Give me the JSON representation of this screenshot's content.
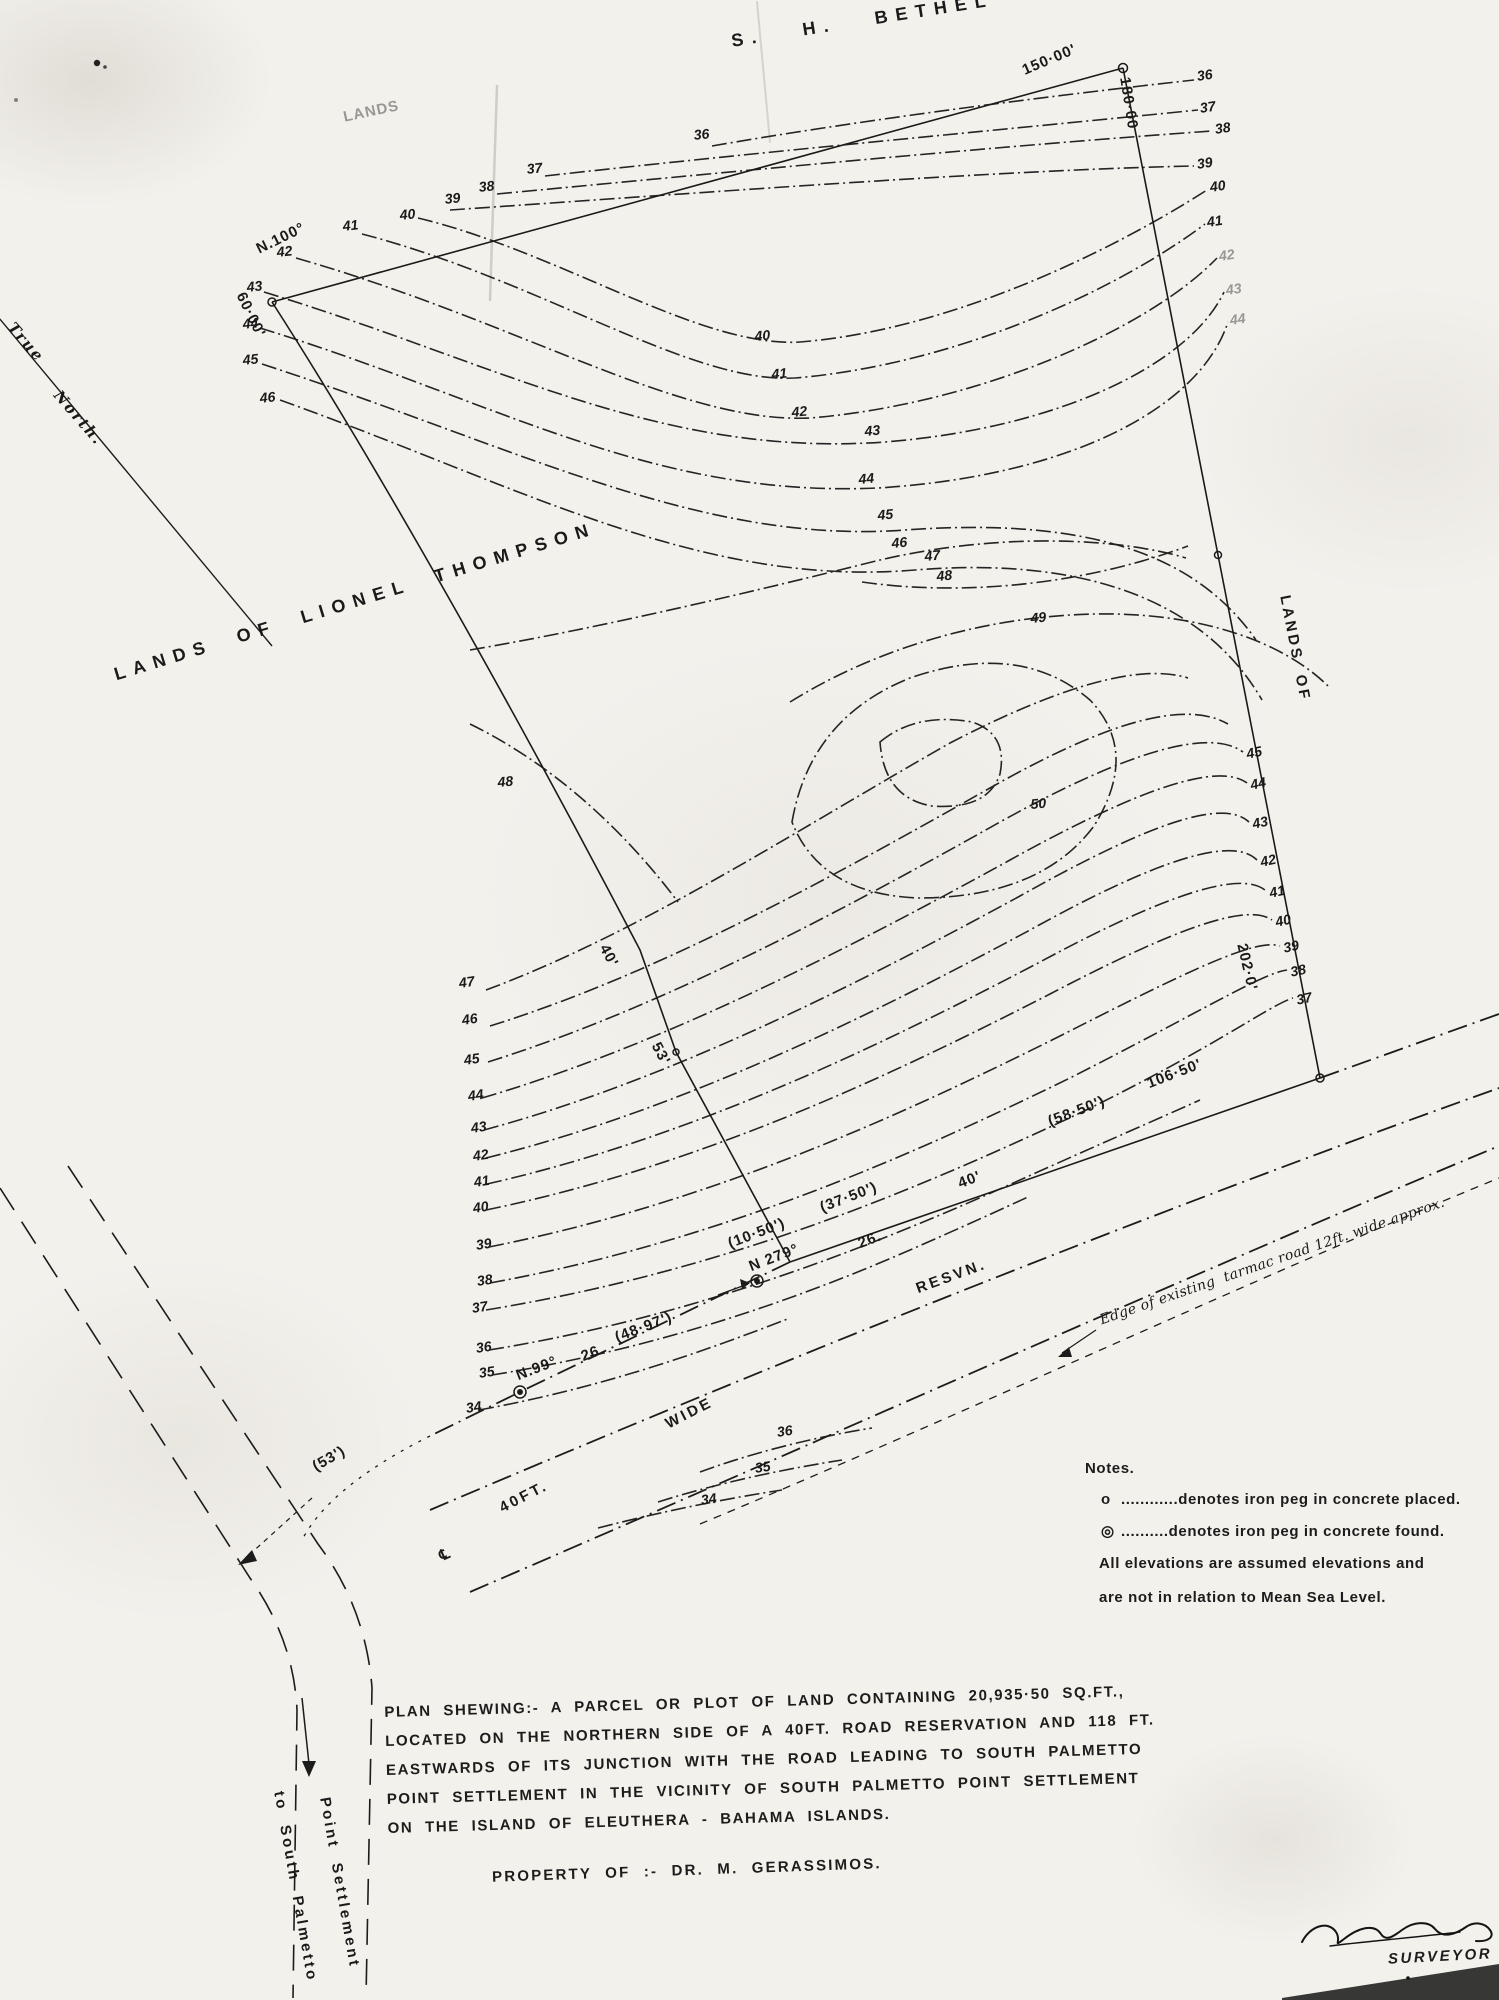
{
  "colors": {
    "ink": "#1c1c1c",
    "paper": "#f3f1ec"
  },
  "north": {
    "label1": "True",
    "label2": "North."
  },
  "notes": {
    "title": "Notes.",
    "rows": [
      {
        "sym": "o",
        "text": "............denotes iron  peg  in concrete  placed."
      },
      {
        "sym": "◎",
        "text": "..........denotes  iron  peg  in concrete  found."
      }
    ],
    "line3": "All elevations  are  assumed  elevations  and",
    "line4": "are  not  in relation  to  Mean  Sea  Level."
  },
  "description": {
    "line1": "PLAN  SHEWING:-   A  PARCEL  OR  PLOT  OF  LAND  CONTAINING  20,935·50 SQ.FT.,",
    "line2": "LOCATED  ON  THE  NORTHERN  SIDE  OF  A  40FT.  ROAD  RESERVATION  AND  118 FT.",
    "line3": "EASTWARDS  OF  ITS  JUNCTION  WITH  THE  ROAD  LEADING  TO  SOUTH  PALMETTO",
    "line4": "POINT  SETTLEMENT  IN  THE  VICINITY  OF  SOUTH  PALMETTO  POINT  SETTLEMENT",
    "line5": "ON  THE  ISLAND  OF  ELEUTHERA - BAHAMA  ISLANDS."
  },
  "property_of": "PROPERTY OF :-   DR.  M. GERASSIMOS.",
  "signature": {
    "role": "SURVEYOR"
  },
  "map_labels": [
    {
      "t": "S.   H.   BETHEL",
      "x": 730,
      "y": 32,
      "r": -9,
      "c": "big",
      "n": "neighbor-top-label"
    },
    {
      "t": "LANDS",
      "x": 342,
      "y": 110,
      "r": -12,
      "c": "med faint",
      "n": "faint-lands-label"
    },
    {
      "t": "LANDS  OF  LIONEL  THOMPSON",
      "x": 112,
      "y": 666,
      "r": -17,
      "c": "big",
      "n": "neighbor-west-label"
    },
    {
      "t": "LANDS  OF",
      "x": 1292,
      "y": 594,
      "r": 79,
      "c": "medsp",
      "n": "neighbor-east-label"
    },
    {
      "t": "True",
      "x": 16,
      "y": 320,
      "r": 49,
      "c": "ser",
      "n": "north-label"
    },
    {
      "t": "North.",
      "x": 62,
      "y": 388,
      "r": 49,
      "c": "ser",
      "n": "north-label"
    },
    {
      "t": "150·00'",
      "x": 1020,
      "y": 64,
      "r": -23,
      "c": "med",
      "n": "distance-label"
    },
    {
      "t": "180·00",
      "x": 1132,
      "y": 76,
      "r": 81,
      "c": "med",
      "n": "distance-label"
    },
    {
      "t": "N.100°",
      "x": 254,
      "y": 243,
      "r": -26,
      "c": "med",
      "n": "bearing-label"
    },
    {
      "t": "60·00'",
      "x": 247,
      "y": 290,
      "r": 64,
      "c": "med",
      "n": "distance-label"
    },
    {
      "t": "40'",
      "x": 610,
      "y": 942,
      "r": 62,
      "c": "med",
      "n": "distance-label"
    },
    {
      "t": "53'",
      "x": 662,
      "y": 1040,
      "r": 62,
      "c": "med",
      "n": "distance-label"
    },
    {
      "t": "202·0'",
      "x": 1249,
      "y": 942,
      "r": 77,
      "c": "med",
      "n": "distance-label"
    },
    {
      "t": "(10·50')",
      "x": 726,
      "y": 1237,
      "r": -21,
      "c": "med",
      "n": "distance-label"
    },
    {
      "t": "N 279°",
      "x": 747,
      "y": 1260,
      "r": -21,
      "c": "med",
      "n": "bearing-label"
    },
    {
      "t": "(37·50')",
      "x": 818,
      "y": 1201,
      "r": -21,
      "c": "med",
      "n": "distance-label"
    },
    {
      "t": "26.",
      "x": 856,
      "y": 1237,
      "r": -21,
      "c": "med",
      "n": "distance-label"
    },
    {
      "t": "40'",
      "x": 956,
      "y": 1177,
      "r": -21,
      "c": "med",
      "n": "distance-label"
    },
    {
      "t": "(58·50')",
      "x": 1046,
      "y": 1115,
      "r": -21,
      "c": "med",
      "n": "distance-label"
    },
    {
      "t": "106·50'",
      "x": 1145,
      "y": 1077,
      "r": -21,
      "c": "med",
      "n": "distance-label"
    },
    {
      "t": "26.",
      "x": 579,
      "y": 1350,
      "r": -21,
      "c": "med",
      "n": "distance-label"
    },
    {
      "t": "(48·97')",
      "x": 613,
      "y": 1331,
      "r": -21,
      "c": "med",
      "n": "distance-label"
    },
    {
      "t": "N.99°",
      "x": 514,
      "y": 1369,
      "r": -21,
      "c": "med",
      "n": "bearing-label"
    },
    {
      "t": "(53')",
      "x": 310,
      "y": 1461,
      "r": -30,
      "c": "med",
      "n": "distance-label"
    },
    {
      "t": "℄",
      "x": 437,
      "y": 1550,
      "r": -24,
      "c": "med",
      "n": "centerline-symbol"
    },
    {
      "t": "40FT.",
      "x": 497,
      "y": 1502,
      "r": -27,
      "c": "medsp",
      "n": "road-label"
    },
    {
      "t": "WIDE",
      "x": 663,
      "y": 1418,
      "r": -27,
      "c": "medsp",
      "n": "road-label"
    },
    {
      "t": "RESVN.",
      "x": 914,
      "y": 1282,
      "r": -20,
      "c": "medsp",
      "n": "road-label"
    },
    {
      "t": "Edge of existing  tarmac road 12ft. wide approx.",
      "x": 1098,
      "y": 1314,
      "r": -19,
      "c": "hand",
      "n": "road-annotation"
    },
    {
      "t": "to  South  Palmetto",
      "x": 286,
      "y": 1790,
      "r": 80,
      "c": "medsp",
      "n": "road-destination-label"
    },
    {
      "t": "Point  Settlement",
      "x": 332,
      "y": 1796,
      "r": 80,
      "c": "medsp",
      "n": "road-destination-label"
    },
    {
      "t": "36",
      "x": 693,
      "y": 128,
      "r": -6,
      "c": "num",
      "n": "contour-label"
    },
    {
      "t": "37",
      "x": 526,
      "y": 162,
      "r": -6,
      "c": "num",
      "n": "contour-label"
    },
    {
      "t": "38",
      "x": 478,
      "y": 180,
      "r": -6,
      "c": "num",
      "n": "contour-label"
    },
    {
      "t": "39",
      "x": 444,
      "y": 192,
      "r": -6,
      "c": "num",
      "n": "contour-label"
    },
    {
      "t": "40",
      "x": 399,
      "y": 208,
      "r": -6,
      "c": "num",
      "n": "contour-label"
    },
    {
      "t": "41",
      "x": 342,
      "y": 219,
      "r": -6,
      "c": "num",
      "n": "contour-label"
    },
    {
      "t": "42",
      "x": 276,
      "y": 245,
      "r": -6,
      "c": "num",
      "n": "contour-label"
    },
    {
      "t": "43",
      "x": 246,
      "y": 280,
      "r": -6,
      "c": "num",
      "n": "contour-label"
    },
    {
      "t": "44",
      "x": 242,
      "y": 317,
      "r": -6,
      "c": "num",
      "n": "contour-label"
    },
    {
      "t": "45",
      "x": 242,
      "y": 353,
      "r": -6,
      "c": "num",
      "n": "contour-label"
    },
    {
      "t": "46",
      "x": 259,
      "y": 391,
      "r": -6,
      "c": "num",
      "n": "contour-label"
    },
    {
      "t": "36",
      "x": 1196,
      "y": 69,
      "r": -8,
      "c": "num",
      "n": "contour-label"
    },
    {
      "t": "37",
      "x": 1199,
      "y": 101,
      "r": -8,
      "c": "num",
      "n": "contour-label"
    },
    {
      "t": "38",
      "x": 1214,
      "y": 122,
      "r": -8,
      "c": "num",
      "n": "contour-label"
    },
    {
      "t": "39",
      "x": 1196,
      "y": 157,
      "r": -8,
      "c": "num",
      "n": "contour-label"
    },
    {
      "t": "40",
      "x": 1209,
      "y": 180,
      "r": -8,
      "c": "num",
      "n": "contour-label"
    },
    {
      "t": "41",
      "x": 1206,
      "y": 215,
      "r": -8,
      "c": "num",
      "n": "contour-label"
    },
    {
      "t": "42",
      "x": 1218,
      "y": 249,
      "r": -8,
      "c": "num faint",
      "n": "contour-label"
    },
    {
      "t": "43",
      "x": 1225,
      "y": 283,
      "r": -8,
      "c": "num faint",
      "n": "contour-label"
    },
    {
      "t": "44",
      "x": 1229,
      "y": 313,
      "r": -8,
      "c": "num faint",
      "n": "contour-label"
    },
    {
      "t": "40",
      "x": 754,
      "y": 329,
      "r": -5,
      "c": "num",
      "n": "contour-label"
    },
    {
      "t": "41",
      "x": 771,
      "y": 367,
      "r": -5,
      "c": "num",
      "n": "contour-label"
    },
    {
      "t": "42",
      "x": 791,
      "y": 405,
      "r": -5,
      "c": "num",
      "n": "contour-label"
    },
    {
      "t": "43",
      "x": 864,
      "y": 424,
      "r": -5,
      "c": "num",
      "n": "contour-label"
    },
    {
      "t": "44",
      "x": 858,
      "y": 472,
      "r": -5,
      "c": "num",
      "n": "contour-label"
    },
    {
      "t": "45",
      "x": 877,
      "y": 508,
      "r": -5,
      "c": "num",
      "n": "contour-label"
    },
    {
      "t": "46",
      "x": 891,
      "y": 536,
      "r": -5,
      "c": "num",
      "n": "contour-label"
    },
    {
      "t": "47",
      "x": 924,
      "y": 549,
      "r": -5,
      "c": "num",
      "n": "contour-label"
    },
    {
      "t": "48",
      "x": 936,
      "y": 569,
      "r": -5,
      "c": "num",
      "n": "contour-label"
    },
    {
      "t": "49",
      "x": 1030,
      "y": 611,
      "r": -5,
      "c": "num",
      "n": "contour-label"
    },
    {
      "t": "50",
      "x": 1030,
      "y": 797,
      "r": -5,
      "c": "num",
      "n": "contour-label"
    },
    {
      "t": "48",
      "x": 497,
      "y": 775,
      "r": -5,
      "c": "num",
      "n": "contour-label"
    },
    {
      "t": "45",
      "x": 1245,
      "y": 747,
      "r": -12,
      "c": "num",
      "n": "contour-label"
    },
    {
      "t": "44",
      "x": 1249,
      "y": 778,
      "r": -12,
      "c": "num",
      "n": "contour-label"
    },
    {
      "t": "43",
      "x": 1251,
      "y": 817,
      "r": -12,
      "c": "num",
      "n": "contour-label"
    },
    {
      "t": "42",
      "x": 1259,
      "y": 855,
      "r": -12,
      "c": "num",
      "n": "contour-label"
    },
    {
      "t": "41",
      "x": 1268,
      "y": 886,
      "r": -12,
      "c": "num",
      "n": "contour-label"
    },
    {
      "t": "40",
      "x": 1274,
      "y": 915,
      "r": -12,
      "c": "num",
      "n": "contour-label"
    },
    {
      "t": "39",
      "x": 1282,
      "y": 941,
      "r": -12,
      "c": "num",
      "n": "contour-label"
    },
    {
      "t": "38",
      "x": 1289,
      "y": 965,
      "r": -12,
      "c": "num",
      "n": "contour-label"
    },
    {
      "t": "37",
      "x": 1295,
      "y": 993,
      "r": -12,
      "c": "num",
      "n": "contour-label"
    },
    {
      "t": "47",
      "x": 458,
      "y": 976,
      "r": -8,
      "c": "num",
      "n": "contour-label"
    },
    {
      "t": "46",
      "x": 461,
      "y": 1013,
      "r": -8,
      "c": "num",
      "n": "contour-label"
    },
    {
      "t": "45",
      "x": 463,
      "y": 1053,
      "r": -8,
      "c": "num",
      "n": "contour-label"
    },
    {
      "t": "44",
      "x": 467,
      "y": 1089,
      "r": -8,
      "c": "num",
      "n": "contour-label"
    },
    {
      "t": "43",
      "x": 470,
      "y": 1121,
      "r": -8,
      "c": "num",
      "n": "contour-label"
    },
    {
      "t": "42",
      "x": 472,
      "y": 1149,
      "r": -8,
      "c": "num",
      "n": "contour-label"
    },
    {
      "t": "41",
      "x": 473,
      "y": 1175,
      "r": -8,
      "c": "num",
      "n": "contour-label"
    },
    {
      "t": "40",
      "x": 472,
      "y": 1201,
      "r": -8,
      "c": "num",
      "n": "contour-label"
    },
    {
      "t": "39",
      "x": 475,
      "y": 1238,
      "r": -8,
      "c": "num",
      "n": "contour-label"
    },
    {
      "t": "38",
      "x": 476,
      "y": 1274,
      "r": -8,
      "c": "num",
      "n": "contour-label"
    },
    {
      "t": "37",
      "x": 471,
      "y": 1301,
      "r": -8,
      "c": "num",
      "n": "contour-label"
    },
    {
      "t": "36",
      "x": 475,
      "y": 1341,
      "r": -8,
      "c": "num",
      "n": "contour-label"
    },
    {
      "t": "35",
      "x": 478,
      "y": 1366,
      "r": -8,
      "c": "num",
      "n": "contour-label"
    },
    {
      "t": "34",
      "x": 465,
      "y": 1401,
      "r": -8,
      "c": "num",
      "n": "contour-label"
    },
    {
      "t": "36",
      "x": 776,
      "y": 1425,
      "r": -8,
      "c": "num",
      "n": "contour-label"
    },
    {
      "t": "35",
      "x": 754,
      "y": 1461,
      "r": -8,
      "c": "num",
      "n": "contour-label"
    },
    {
      "t": "34",
      "x": 700,
      "y": 1493,
      "r": -8,
      "c": "num",
      "n": "contour-label"
    }
  ]
}
